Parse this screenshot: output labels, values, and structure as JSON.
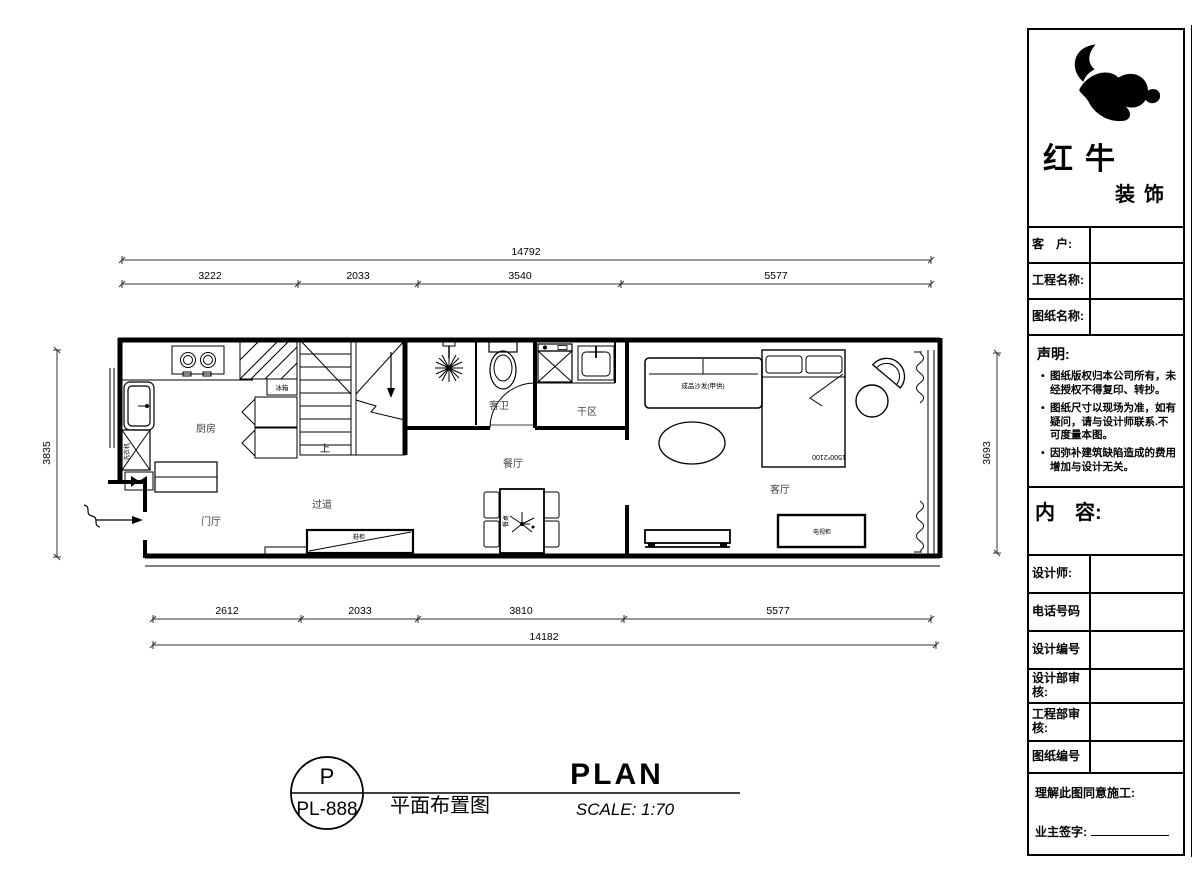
{
  "logo": {
    "company_name": "红牛",
    "company_sub": "装饰"
  },
  "title_block": {
    "client_label": "客　户:",
    "project_label": "工程名称:",
    "drawing_label": "图纸名称:",
    "statement_title": "声明:",
    "statement_items": [
      "图纸版权归本公司所有，未经授权不得复印、转抄。",
      "图纸尺寸以现场为准，如有疑问，请与设计师联系.不可度量本图。",
      "因弥补建筑缺陷造成的费用增加与设计无关。"
    ],
    "content_label": "内　容:",
    "designer_label": "设计师:",
    "phone_label": "电话号码",
    "design_no_label": "设计编号",
    "design_review_label": "设计部审核:",
    "engineering_review_label": "工程部审核:",
    "drawing_no_label": "图纸编号",
    "agreement_label": "理解此图同意施工:",
    "signature_label": "业主签字:"
  },
  "plan": {
    "rooms": {
      "kitchen": "厨房",
      "foyer": "门厅",
      "hallway": "过道",
      "dining": "餐厅",
      "guest_bath": "客卫",
      "dry_area": "干区",
      "living": "客厅"
    },
    "fixtures": {
      "sofa": "成品沙发(甲供)",
      "bed_size": "1500*2100",
      "fridge": "冰箱",
      "washer": "洗衣机",
      "tv_cabinet": "电视柜",
      "shoe_cabinet": "鞋柜",
      "dining_table": "餐桌",
      "stairs_up": "上"
    },
    "dimensions": {
      "top_total": "14792",
      "top_segments": [
        "3222",
        "2033",
        "3540",
        "5577"
      ],
      "bottom_segments": [
        "2612",
        "2033",
        "3810",
        "5577"
      ],
      "bottom_total": "14182",
      "left_height": "3835",
      "right_height": "3693"
    }
  },
  "footer": {
    "badge_letter": "P",
    "badge_number": "PL-888",
    "title_cn": "平面布置图",
    "title_en": "PLAN",
    "scale": "SCALE: 1:70"
  }
}
